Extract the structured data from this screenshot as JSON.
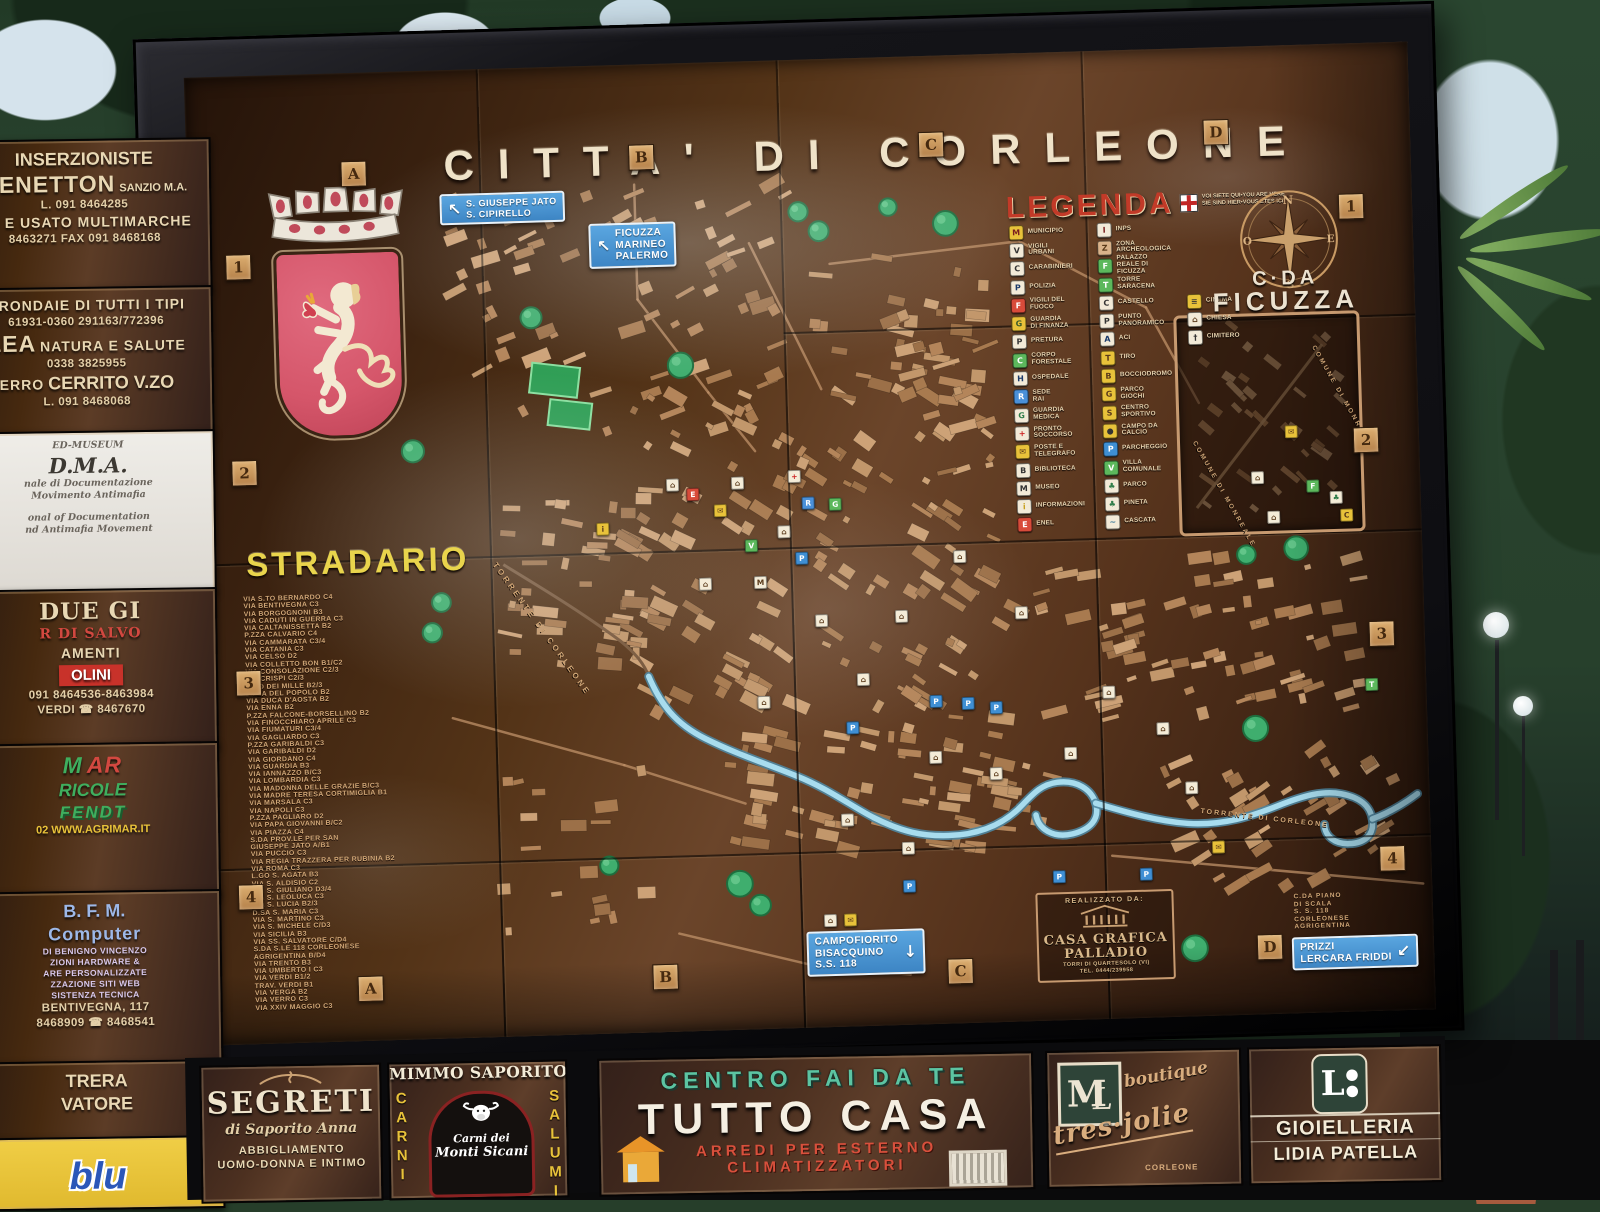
{
  "board": {
    "title": "CITTA' DI CORLEONE",
    "grid": {
      "top": [
        "A",
        "B",
        "C",
        "D"
      ],
      "bottom": [
        "A",
        "B",
        "C",
        "D"
      ],
      "left": [
        "1",
        "2",
        "3",
        "4"
      ],
      "right": [
        "1",
        "2",
        "3",
        "4"
      ]
    },
    "stradario": {
      "heading": "STRADARIO",
      "entries": [
        "VIA S.TO BERNARDO C4",
        "VIA BENTIVEGNA C3",
        "VIA BORGOGNONI B3",
        "VIA CADUTI IN GUERRA C3",
        "VIA CALTANISSETTA B2",
        "P.ZZA CALVARIO C4",
        "VIA CAMMARATA C3/4",
        "VIA CATANIA C3",
        "VIA CELSO D2",
        "VIA COLLETTO BON B1/C2",
        "VIA CONSOLAZIONE C2/3",
        "VIA CRISPI C2/3",
        "C.SO DEI MILLE B2/3",
        "P.ZZA DEL POPOLO B2",
        "VIA DUCA D'AOSTA B2",
        "VIA ENNA B2",
        "P.ZZA FALCONE-BORSELLINO B2",
        "VIA FINOCCHIARO APRILE C3",
        "VIA FIUMATURI C3/4",
        "VIA GAGLIARDO C3",
        "P.ZZA GARIBALDI C3",
        "VIA GARIBALDI D2",
        "VIA GIORDANO C4",
        "VIA GUARDIA B3",
        "VIA IANNAZZO B/C3",
        "VIA LOMBARDIA C3",
        "VIA MADONNA DELLE GRAZIE B/C3",
        "VIA MADRE TERESA CORTIMIGLIA B1",
        "VIA MARSALA C3",
        "VIA NAPOLI C3",
        "P.ZZA PAGLIARO D2",
        "VIA PAPA GIOVANNI B/C2",
        "VIA PIAZZA C4",
        "S.DA PROV.LE PER SAN\n      GIUSEPPE JATO A/B1",
        "VIA PUCCIO C3",
        "VIA REGIA TRAZZERA PER RUBINIA B2",
        "VIA ROMA C3",
        "L.GO S. AGATA B3",
        "VIA S. ALDISIO C2",
        "VIA S. GIULIANO D3/4",
        "VIA S. LEOLUCA C3",
        "VIA S. LUCIA B2/3",
        "D.SA S. MARIA C3",
        "VIA S. MARTINO C3",
        "VIA S. MICHELE C/D3",
        "VIA SICILIA B3",
        "VIA SS. SALVATORE C/D4",
        "S.DA S.LE 118 CORLEONESE\n      AGRIGENTINA B/D4",
        "VIA TRENTO B3",
        "VIA UMBERTO I C3",
        "VIA VERDI B1/2",
        "TRAV. VERDI B1",
        "VIA VERGA B2",
        "VIA VERRO C3",
        "VIA XXIV MAGGIO C3"
      ]
    },
    "legend": {
      "heading": "LEGENDA",
      "you_are_here": {
        "line1": "VOI SIETE QUI•YOU ARE HERE",
        "line2": "SIE SIND HIER•VOUS ETES ICI"
      },
      "col1": [
        {
          "label": "MUNICIPIO",
          "b": "#e8c23a",
          "f": "#7a1f1f",
          "g": "M"
        },
        {
          "label": "VIGILI\nURBANI",
          "b": "#f2ead8",
          "f": "#333333",
          "g": "V"
        },
        {
          "label": "CARABINIERI",
          "b": "#f2ead8",
          "f": "#333333",
          "g": "C"
        },
        {
          "label": "POLIZIA",
          "b": "#f2ead8",
          "f": "#1a3a6a",
          "g": "P"
        },
        {
          "label": "VIGILI DEL\nFUOCO",
          "b": "#d84b3a",
          "f": "#ffffff",
          "g": "F"
        },
        {
          "label": "GUARDIA\nDI FINANZA",
          "b": "#e8c23a",
          "f": "#3a5a2a",
          "g": "G"
        },
        {
          "label": "PRETURA",
          "b": "#f2ead8",
          "f": "#333333",
          "g": "P"
        },
        {
          "label": "CORPO\nFORESTALE",
          "b": "#5cb85c",
          "f": "#ffffff",
          "g": "C"
        },
        {
          "label": "OSPEDALE",
          "b": "#f2ead8",
          "f": "#1a3a6a",
          "g": "H"
        },
        {
          "label": "SEDE\nRAI",
          "b": "#4a90d9",
          "f": "#ffffff",
          "g": "R"
        },
        {
          "label": "GUARDIA\nMEDICA",
          "b": "#f2ead8",
          "f": "#2f7d4a",
          "g": "G"
        },
        {
          "label": "PRONTO\nSOCCORSO",
          "b": "#f2ead8",
          "f": "#cc2222",
          "g": "+"
        },
        {
          "label": "POSTE E\nTELEGRAFO",
          "b": "#e8c23a",
          "f": "#5a3a1a",
          "g": "✉"
        },
        {
          "label": "BIBLIOTECA",
          "b": "#f2ead8",
          "f": "#333333",
          "g": "B"
        },
        {
          "label": "MUSEO",
          "b": "#f2ead8",
          "f": "#333333",
          "g": "M"
        },
        {
          "label": "INFORMAZIONI",
          "b": "#f2ead8",
          "f": "#c8a020",
          "g": "i"
        },
        {
          "label": "ENEL",
          "b": "#d84b3a",
          "f": "#ffffff",
          "g": "E"
        }
      ],
      "col2": [
        {
          "label": "INPS",
          "b": "#f2ead8",
          "f": "#7a1f1f",
          "g": "I"
        },
        {
          "label": "ZONA\nARCHEOLOGICA",
          "b": "#d9b38a",
          "f": "#5a3a1a",
          "g": "Z"
        },
        {
          "label": "PALAZZO\nREALE DI\nFICUZZA",
          "b": "#5cb85c",
          "f": "#ffffff",
          "g": "F"
        },
        {
          "label": "TORRE\nSARACENA",
          "b": "#5cb85c",
          "f": "#ffffff",
          "g": "T"
        },
        {
          "label": "CASTELLO",
          "b": "#f2ead8",
          "f": "#333333",
          "g": "C"
        },
        {
          "label": "PUNTO\nPANORAMICO",
          "b": "#f2ead8",
          "f": "#333333",
          "g": "P"
        },
        {
          "label": "ACI",
          "b": "#f2ead8",
          "f": "#1a3a6a",
          "g": "A"
        },
        {
          "label": "TIRO",
          "b": "#e8c23a",
          "f": "#5a3a1a",
          "g": "T"
        },
        {
          "label": "BOCCIODROMO",
          "b": "#e8c23a",
          "f": "#5a3a1a",
          "g": "B"
        },
        {
          "label": "PARCO\nGIOCHI",
          "b": "#e8c23a",
          "f": "#5a3a1a",
          "g": "G"
        },
        {
          "label": "CENTRO\nSPORTIVO",
          "b": "#e8c23a",
          "f": "#5a3a1a",
          "g": "S"
        },
        {
          "label": "CAMPO DA\nCALCIO",
          "b": "#e8c23a",
          "f": "#333333",
          "g": "●"
        },
        {
          "label": "PARCHEGGIO",
          "b": "#3f8fd4",
          "f": "#ffffff",
          "g": "P"
        },
        {
          "label": "VILLA\nCOMUNALE",
          "b": "#5cb85c",
          "f": "#ffffff",
          "g": "V"
        },
        {
          "label": "PARCO",
          "b": "#f2ead8",
          "f": "#2f7d4a",
          "g": "♣"
        },
        {
          "label": "PINETA",
          "b": "#f2ead8",
          "f": "#2f7d4a",
          "g": "♣"
        },
        {
          "label": "CASCATA",
          "b": "#f2ead8",
          "f": "#3a7a9a",
          "g": "~"
        }
      ],
      "col3": [
        {
          "label": "CINEMA",
          "b": "#e8c23a",
          "f": "#333333",
          "g": "≡"
        },
        {
          "label": "CHIESA",
          "b": "#f2ead8",
          "f": "#5a3a1a",
          "g": "⌂"
        },
        {
          "label": "CIMITERO",
          "b": "#f2ead8",
          "f": "#333333",
          "g": "†"
        }
      ]
    },
    "compass": {
      "n": "N",
      "e": "E",
      "s": "S",
      "o": "O"
    },
    "ficuzza": {
      "line1": "C·DA",
      "line2": "FICUZZA",
      "comune": "COMUNE DI MONREALE"
    },
    "river_label": "TORRENTE DI CORLEONE",
    "piano_di_scala": "C.DA PIANO\nDI SCALA\nS. S. 118\nCORLEONESE\nAGRIGENTINA",
    "signs": {
      "jato": {
        "arrow": "↖",
        "l1": "S. GIUSEPPE JATO",
        "l2": "S. CIPIRELLO"
      },
      "ficuzza": {
        "arrow": "↖",
        "l1": "FICUZZA",
        "l2": "MARINEO",
        "l3": "PALERMO"
      },
      "campofiorito": {
        "arrow": "↓",
        "l1": "CAMPOFIORITO",
        "l2": "BISACQUINO",
        "l3": "S.S. 118"
      },
      "prizzi": {
        "arrow": "↙",
        "l1": "PRIZZI",
        "l2": "LERCARA FRIDDI"
      }
    },
    "credits": {
      "line1": "REALIZZATO DA:",
      "name1": "CASA GRAFICA",
      "name2": "PALLADIO",
      "line2": "TORRI DI QUARTESOLO (VI)",
      "line3": "TEL. 0444/239958"
    },
    "markers": [
      {
        "x": 602,
        "y": 497,
        "b": "#3f8fd4",
        "f": "#ffffff",
        "g": "P"
      },
      {
        "x": 732,
        "y": 644,
        "b": "#3f8fd4",
        "f": "#ffffff",
        "g": "P"
      },
      {
        "x": 764,
        "y": 647,
        "b": "#3f8fd4",
        "f": "#ffffff",
        "g": "P"
      },
      {
        "x": 792,
        "y": 652,
        "b": "#3f8fd4",
        "f": "#ffffff",
        "g": "P"
      },
      {
        "x": 648,
        "y": 668,
        "b": "#3f8fd4",
        "f": "#ffffff",
        "g": "P"
      },
      {
        "x": 850,
        "y": 823,
        "b": "#3f8fd4",
        "f": "#ffffff",
        "g": "P"
      },
      {
        "x": 937,
        "y": 823,
        "b": "#3f8fd4",
        "f": "#ffffff",
        "g": "P"
      },
      {
        "x": 700,
        "y": 828,
        "b": "#3f8fd4",
        "f": "#ffffff",
        "g": "P"
      },
      {
        "x": 597,
        "y": 415,
        "b": "#f4ecd8",
        "f": "#cc2222",
        "g": "+"
      },
      {
        "x": 610,
        "y": 442,
        "b": "#4a90d9",
        "f": "#ffffff",
        "g": "R"
      },
      {
        "x": 637,
        "y": 444,
        "b": "#5cb85c",
        "f": "#ffffff",
        "g": "G"
      },
      {
        "x": 522,
        "y": 447,
        "b": "#e8c23a",
        "f": "#5a3a1a",
        "g": "✉"
      },
      {
        "x": 404,
        "y": 462,
        "b": "#e8c23a",
        "f": "#5a3a1a",
        "g": "i"
      },
      {
        "x": 552,
        "y": 483,
        "b": "#5cb85c",
        "f": "#ffffff",
        "g": "V"
      },
      {
        "x": 495,
        "y": 430,
        "b": "#d84b3a",
        "f": "#ffffff",
        "g": "E"
      },
      {
        "x": 560,
        "y": 520,
        "b": "#f4ecd8",
        "f": "#5a3a1a",
        "g": "M"
      },
      {
        "x": 540,
        "y": 420,
        "b": "#f4ecd8",
        "f": "#5a3a1a",
        "g": "⌂"
      },
      {
        "x": 585,
        "y": 470,
        "b": "#f4ecd8",
        "f": "#5a3a1a",
        "g": "⌂"
      },
      {
        "x": 620,
        "y": 560,
        "b": "#f4ecd8",
        "f": "#5a3a1a",
        "g": "⌂"
      },
      {
        "x": 700,
        "y": 558,
        "b": "#f4ecd8",
        "f": "#5a3a1a",
        "g": "⌂"
      },
      {
        "x": 760,
        "y": 500,
        "b": "#f4ecd8",
        "f": "#5a3a1a",
        "g": "⌂"
      },
      {
        "x": 820,
        "y": 558,
        "b": "#f4ecd8",
        "f": "#5a3a1a",
        "g": "⌂"
      },
      {
        "x": 660,
        "y": 620,
        "b": "#f4ecd8",
        "f": "#5a3a1a",
        "g": "⌂"
      },
      {
        "x": 730,
        "y": 700,
        "b": "#f4ecd8",
        "f": "#5a3a1a",
        "g": "⌂"
      },
      {
        "x": 790,
        "y": 718,
        "b": "#f4ecd8",
        "f": "#5a3a1a",
        "g": "⌂"
      },
      {
        "x": 640,
        "y": 760,
        "b": "#f4ecd8",
        "f": "#5a3a1a",
        "g": "⌂"
      },
      {
        "x": 700,
        "y": 790,
        "b": "#f4ecd8",
        "f": "#5a3a1a",
        "g": "⌂"
      },
      {
        "x": 560,
        "y": 640,
        "b": "#f4ecd8",
        "f": "#5a3a1a",
        "g": "⌂"
      },
      {
        "x": 505,
        "y": 520,
        "b": "#f4ecd8",
        "f": "#5a3a1a",
        "g": "⌂"
      },
      {
        "x": 475,
        "y": 420,
        "b": "#f4ecd8",
        "f": "#5a3a1a",
        "g": "⌂"
      },
      {
        "x": 905,
        "y": 640,
        "b": "#f4ecd8",
        "f": "#5a3a1a",
        "g": "⌂"
      },
      {
        "x": 958,
        "y": 678,
        "b": "#f4ecd8",
        "f": "#5a3a1a",
        "g": "⌂"
      },
      {
        "x": 865,
        "y": 700,
        "b": "#f4ecd8",
        "f": "#5a3a1a",
        "g": "⌂"
      },
      {
        "x": 985,
        "y": 738,
        "b": "#f4ecd8",
        "f": "#5a3a1a",
        "g": "⌂"
      },
      {
        "x": 620,
        "y": 860,
        "b": "#f4ecd8",
        "f": "#5a3a1a",
        "g": "⌂"
      },
      {
        "x": 640,
        "y": 860,
        "b": "#e8c23a",
        "f": "#5a3a1a",
        "g": "✉"
      },
      {
        "x": 1010,
        "y": 798,
        "b": "#e8c23a",
        "f": "#5a3a1a",
        "g": "✉"
      },
      {
        "x": 1168,
        "y": 640,
        "b": "#5cb85c",
        "f": "#ffffff",
        "g": "T"
      },
      {
        "x": 1095,
        "y": 385,
        "b": "#e8c23a",
        "f": "#5a3a1a",
        "g": "✉"
      },
      {
        "x": 1060,
        "y": 430,
        "b": "#f4ecd8",
        "f": "#5a3a1a",
        "g": "⌂"
      },
      {
        "x": 1115,
        "y": 440,
        "b": "#5cb85c",
        "f": "#ffffff",
        "g": "F"
      },
      {
        "x": 1138,
        "y": 452,
        "b": "#f4ecd8",
        "f": "#2f7d4a",
        "g": "♣"
      },
      {
        "x": 1148,
        "y": 470,
        "b": "#e8c23a",
        "f": "#5a3a1a",
        "g": "C"
      },
      {
        "x": 1075,
        "y": 470,
        "b": "#f4ecd8",
        "f": "#5a3a1a",
        "g": "⌂"
      }
    ]
  },
  "left_ads": {
    "panels": [
      {
        "id": "a1",
        "lines": [
          {
            "t": "INSERZIONISTE",
            "c": "xl"
          },
          {
            "t": "BENETTON",
            "c": "in xxl"
          },
          {
            "t": "SANZIO M.A.",
            "c": "in md"
          },
          {
            "t": "L. 091 8464285",
            "c": "tel"
          },
          {
            "t": "VO E USATO MULTIMARCHE",
            "c": "lg"
          },
          {
            "t": "8463271 FAX 091 8468168",
            "c": "tel"
          }
        ]
      },
      {
        "id": "a2",
        "lines": [
          {
            "t": "GRONDAIE DI TUTTI I TIPI",
            "c": "lg"
          },
          {
            "t": "61931-0360 291163/772396",
            "c": "tel"
          },
          {
            "t": "LEA",
            "c": "in xxl"
          },
          {
            "t": "NATURA E SALUTE",
            "c": "in lg"
          },
          {
            "t": "0338 3825955",
            "c": "tel"
          },
          {
            "t": "ERRO",
            "c": "in lg"
          },
          {
            "t": "CERRITO V.ZO",
            "c": "in xl"
          },
          {
            "t": "L. 091 8468068",
            "c": "tel"
          }
        ]
      },
      {
        "id": "dma",
        "cls": "dma-panel",
        "lines": [
          {
            "t": "ED-MUSEUM",
            "c": "dma-sm"
          },
          {
            "t": "D.M.A.",
            "c": "dma-lg"
          },
          {
            "t": "nale di Documentazione",
            "c": "dma-sm"
          },
          {
            "t": "Movimento Antimafia",
            "c": "dma-sm"
          },
          {
            "t": "",
            "c": "gapline"
          },
          {
            "t": "onal of Documentation",
            "c": "dma-sm"
          },
          {
            "t": "nd Antimafia Movement",
            "c": "dma-sm"
          }
        ]
      },
      {
        "id": "duegi",
        "lines": [
          {
            "t": "DUE GI",
            "c": "xxl serif"
          },
          {
            "t": "R DI SALVO",
            "c": "lg serif red"
          },
          {
            "t": "AMENTI",
            "c": "lg"
          },
          {
            "t": "OLINI",
            "c": "redbox"
          },
          {
            "t": "091 8464536-8463984",
            "c": "tel"
          },
          {
            "t": "VERDI ☎ 8467670",
            "c": "tel"
          }
        ]
      },
      {
        "id": "mar",
        "lines": [
          {
            "t": "M",
            "c": "in g-it xxl"
          },
          {
            "t": "AR",
            "c": "in r-it xxl"
          },
          {
            "t": "RICOLE",
            "c": "g-it xl"
          },
          {
            "t": "FENDT",
            "c": "fendt"
          },
          {
            "t": "02 WWW.AGRIMAR.IT",
            "c": "tel-y"
          }
        ]
      },
      {
        "id": "bfm",
        "lines": [
          {
            "t": "B. F. M.",
            "c": "blue xl"
          },
          {
            "t": "Computer",
            "c": "blue xl round"
          },
          {
            "t": "DI BENIGNO VINCENZO",
            "c": "sm-v"
          },
          {
            "t": "ZIONI HARDWARE &",
            "c": "sm-v"
          },
          {
            "t": "ARE PERSONALIZZATE",
            "c": "sm-v"
          },
          {
            "t": "ZZAZIONE SITI WEB",
            "c": "sm-v"
          },
          {
            "t": "SISTENZA TECNICA",
            "c": "sm-v"
          },
          {
            "t": "BENTIVEGNA, 117",
            "c": "tel"
          },
          {
            "t": "8468909 ☎ 8468541",
            "c": "tel"
          }
        ]
      },
      {
        "id": "trera",
        "lines": [
          {
            "t": "TRERA",
            "c": "xl"
          },
          {
            "t": "VATORE",
            "c": "xl"
          }
        ]
      },
      {
        "id": "blu",
        "cls": "blu-panel",
        "lines": [
          {
            "t": "blu",
            "c": "blu-word"
          }
        ]
      }
    ]
  },
  "bottom_ads": {
    "segreti": {
      "name": "SEGRETI",
      "script": "di Saporito Anna",
      "line1": "ABBIGLIAMENTO",
      "line2": "UOMO-DONNA E INTIMO"
    },
    "mimmo": {
      "title": "MIMMO SAPORITO",
      "left_vertical": "CARNI",
      "right_vertical": "SALUMI",
      "oval1": "Carni dei",
      "oval2": "Monti Sicani"
    },
    "tuttocasa": {
      "line1": "CENTRO FAI DA TE",
      "line2": "TUTTO CASA",
      "line3": "ARREDI PER ESTERNO",
      "line4": "CLIMATIZZATORI"
    },
    "tresjolie": {
      "m1": "M",
      "m2": "L",
      "word1": "boutique",
      "word2": "tres·jolie",
      "word3": "CORLEONE"
    },
    "gioielleria": {
      "lp": "L",
      "line1": "GIOIELLERIA",
      "line2": "LIDIA PATELLA"
    }
  }
}
